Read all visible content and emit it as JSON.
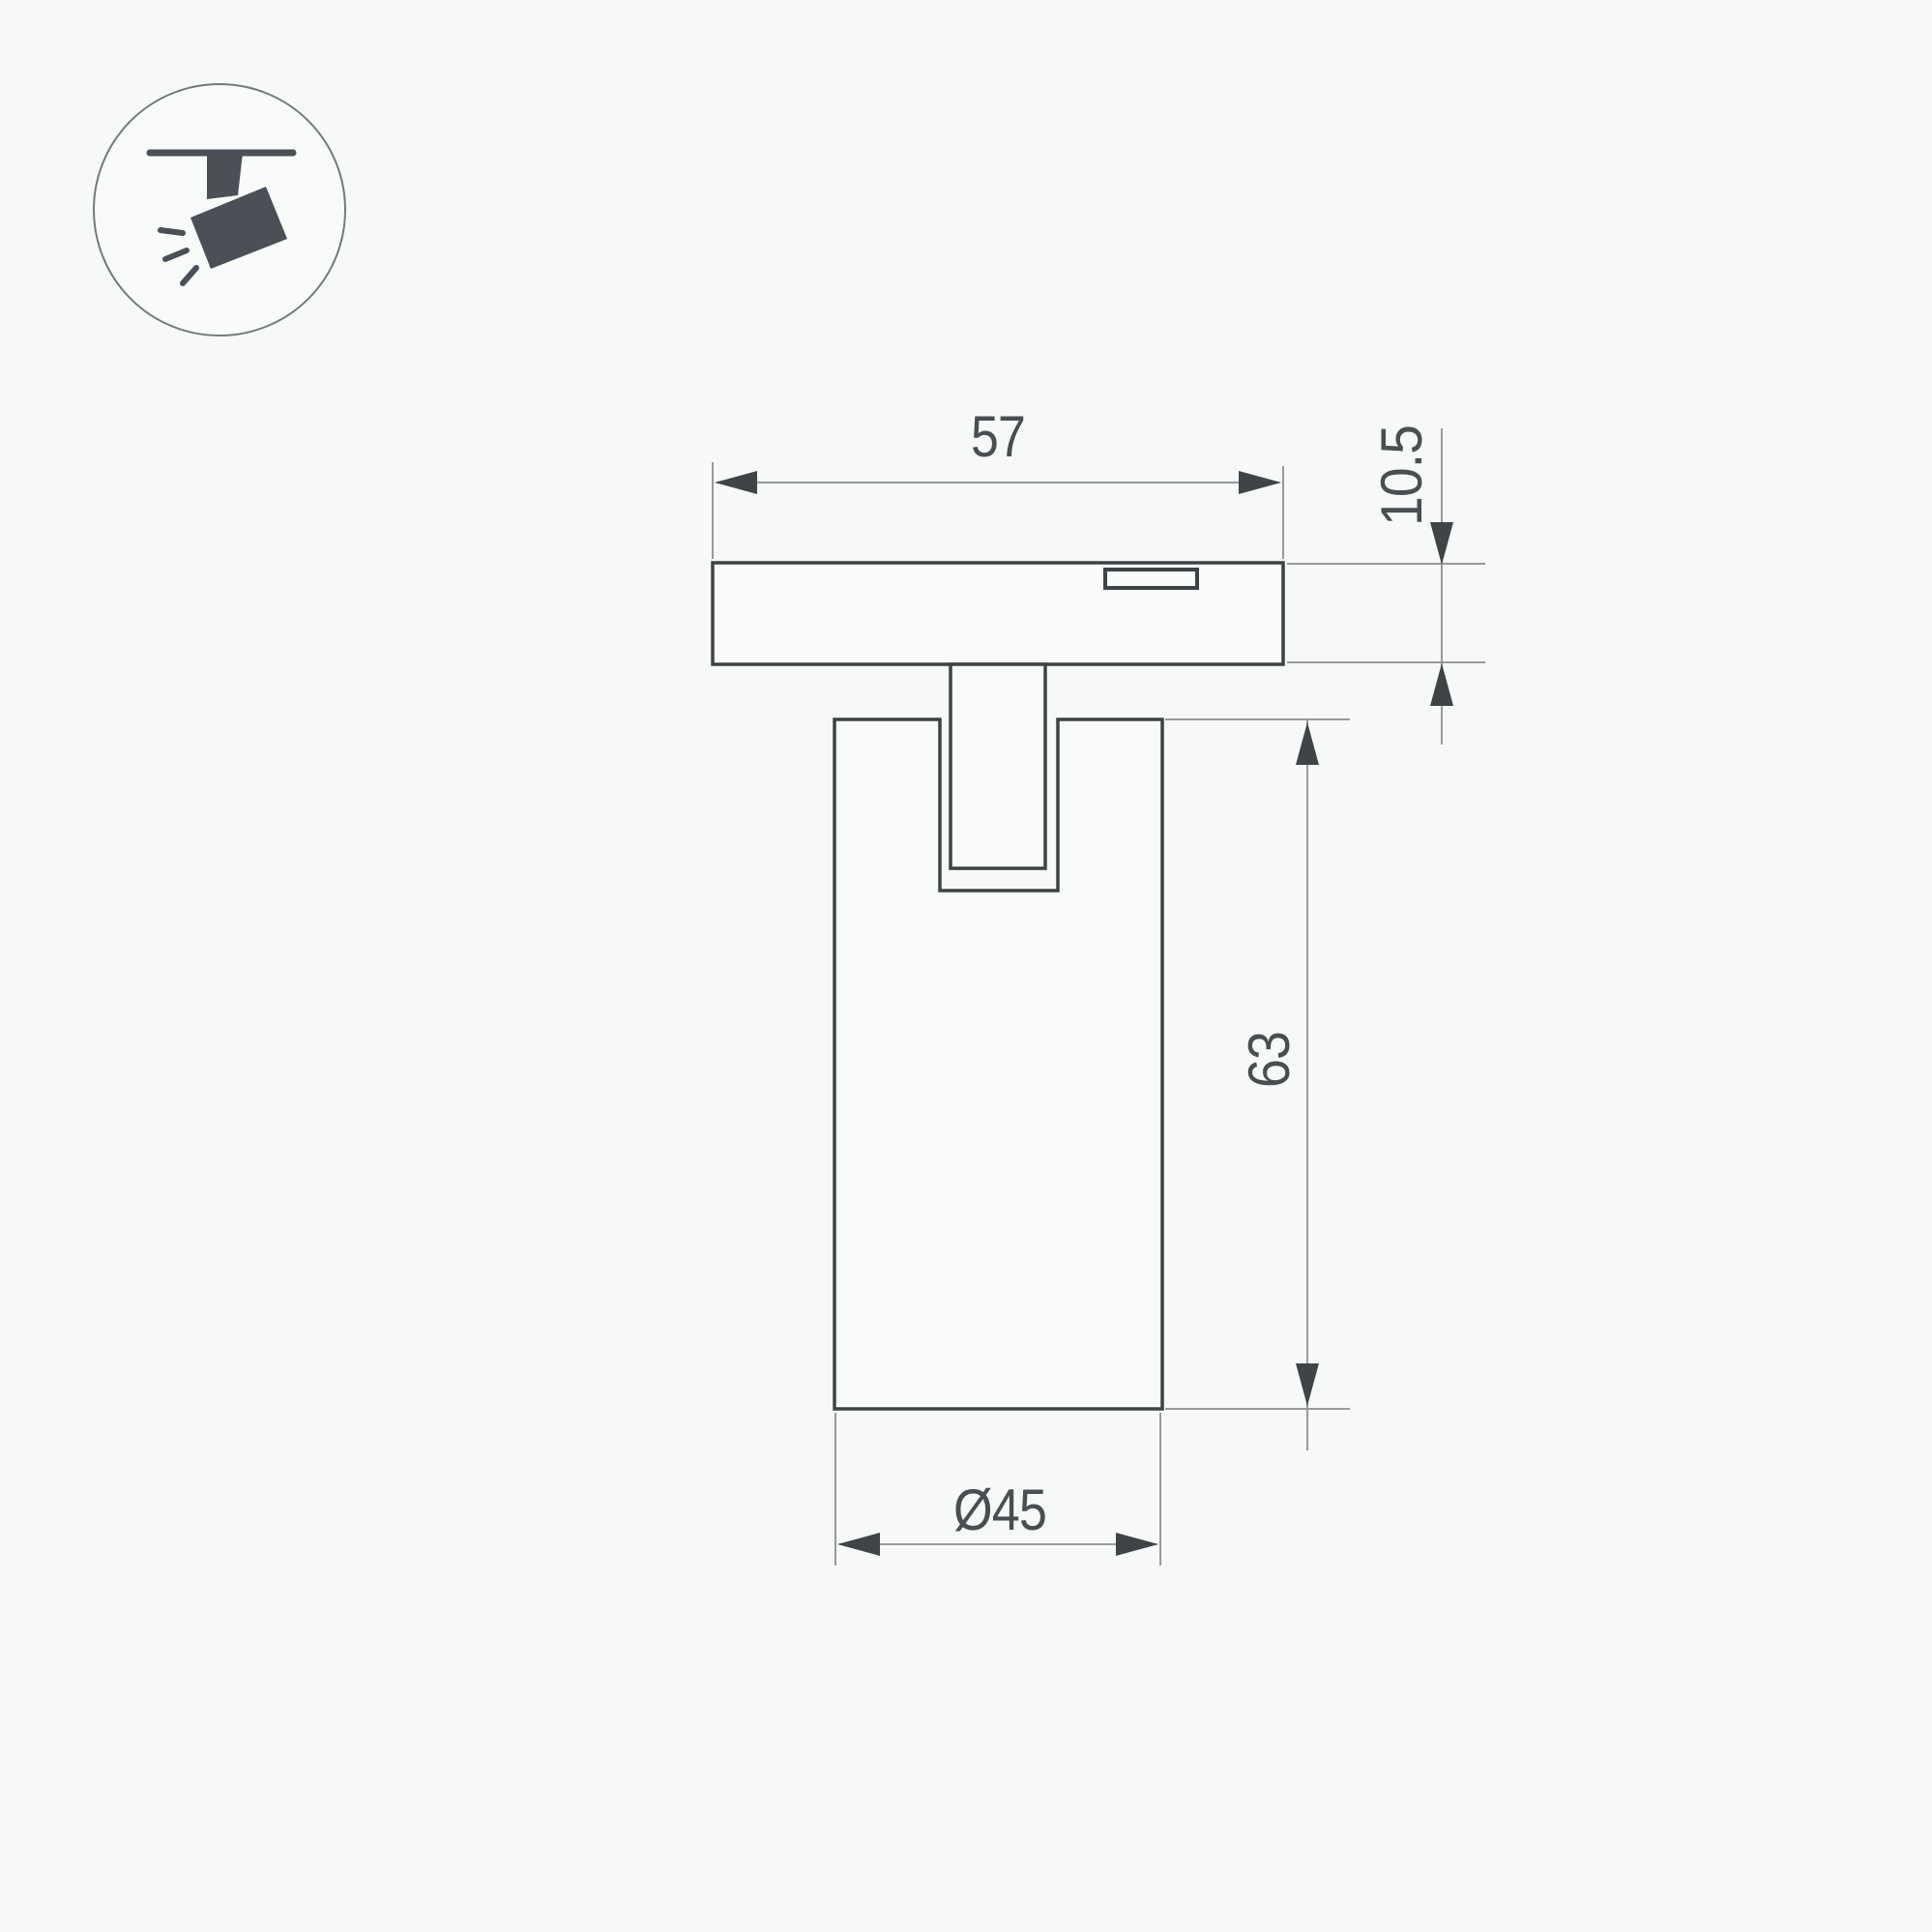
{
  "page": {
    "background": "#f7f8f8"
  },
  "icon": {
    "name": "track-spotlight",
    "glyph_color": "#4a5055",
    "circle_outline_color": "#75797c"
  },
  "drawing": {
    "outline_color": "#3e4245",
    "dim_line_color": "#97999b",
    "arrow_color": "#404447",
    "text_color": "#4a4e51",
    "dimensions": {
      "plate_width": "57",
      "plate_height": "10.5",
      "body_height": "63",
      "body_diameter": "Ø45"
    }
  }
}
